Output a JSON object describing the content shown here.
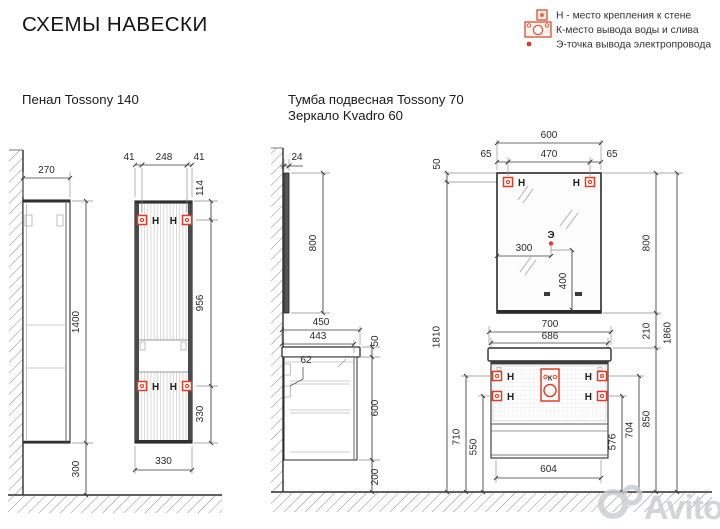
{
  "title": "СХЕМЫ НАВЕСКИ",
  "legend": [
    {
      "label": "Н - место крепления к стене"
    },
    {
      "label": "К-место вывода воды и слива"
    },
    {
      "label": "Э-точка вывода электропровода"
    }
  ],
  "penal": {
    "title": "Пенал Tossony 140",
    "dims": {
      "depth": "270",
      "height": "1400",
      "floor_gap": "300",
      "top_left": "41",
      "top_mid": "248",
      "top_right": "41",
      "side_top": "114",
      "side_mid": "956",
      "side_bottom": "330",
      "width": "330"
    }
  },
  "tumba": {
    "title1": "Тумба подвесная Tossony 70",
    "title2": "Зеркало Kvadro 60",
    "dims": {
      "mirror_depth": "24",
      "mirror_side_h": "800",
      "top_depth": "450",
      "cab_depth": "443",
      "top_thick": "50",
      "rail": "62",
      "cab_h": "600",
      "floor_gap": "200",
      "mount_h": "1810",
      "mirror_top_off": "50",
      "mirror_w": "600",
      "m_off_l": "65",
      "m_span": "470",
      "m_off_r": "65",
      "e_left": "300",
      "e_bottom": "400",
      "mirror_h": "800",
      "gap": "210",
      "total_h": "1860",
      "top_w": "700",
      "cab_w": "686",
      "h_upper_left": "710",
      "h_lower_left": "550",
      "h_lower_right": "576",
      "h_upper_right": "704",
      "top_from_floor": "850",
      "bottom_w": "604"
    }
  },
  "markers": {
    "h": "Н",
    "k": "К",
    "e": "Э"
  },
  "watermark": "Avito",
  "colors": {
    "marker_red": "#e43b25",
    "legend_red": "#d95b41",
    "line": "#3c3c3c",
    "watermark": "#c9cdd0"
  }
}
